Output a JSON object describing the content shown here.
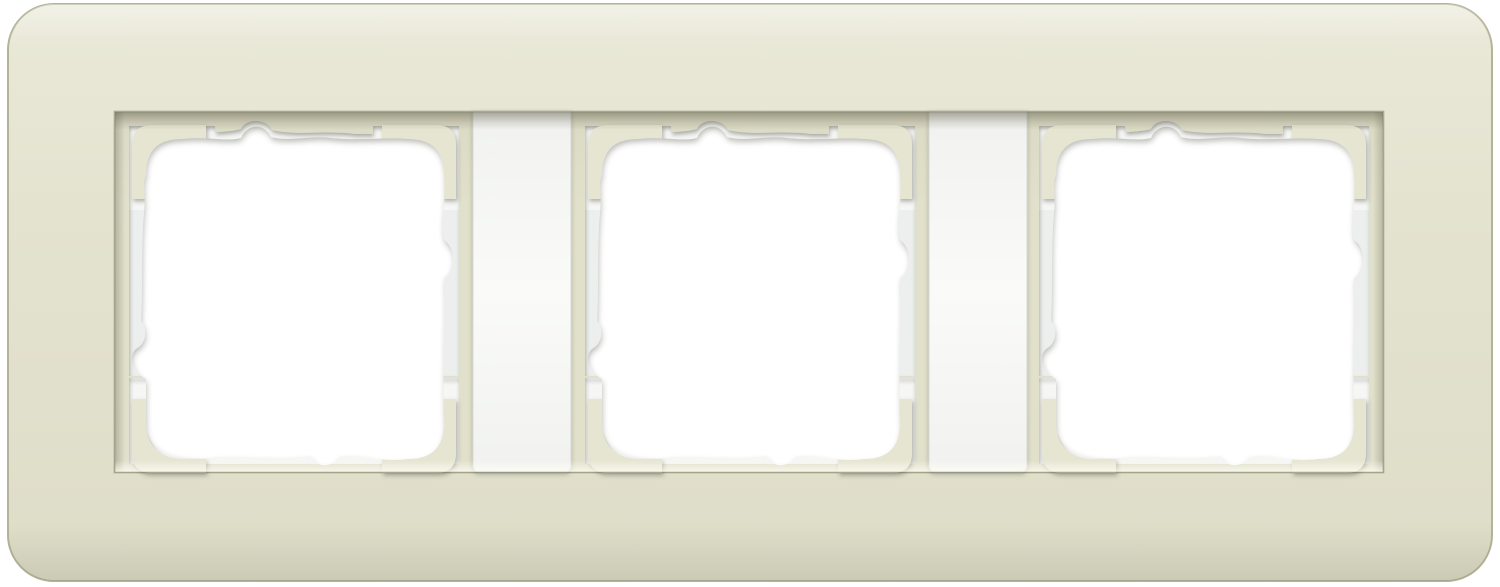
{
  "image": {
    "width": 1500,
    "height": 587,
    "description": "Product photo of a 3-gang electrical switch cover frame, sand colour with white inner carrier frame and two white divider bars",
    "openings_count": 3,
    "divider_count": 2
  },
  "colors": {
    "page_background": "#ffffff",
    "frame_sand_light": "#EAE9D8",
    "frame_sand": "#E4E3D0",
    "frame_sand_deep": "#DEDDC8",
    "frame_outline": "#B4B299",
    "recess_floor": "#E1E0CB",
    "recess_floor_dark": "#DBDAC4",
    "recess_edge_shadow": "#5A5844",
    "carrier_white": "#F6F7F5",
    "carrier_strip_grey": "#EDEFEE",
    "divider_top": "#F1F2F0",
    "divider_bottom": "#FAFBF9",
    "divider_edge": "#D8DAD6",
    "corner_band_sand": "#E6E5D2",
    "hole_white": "#FFFFFF",
    "recess_bottom_light": "#F4F3E4"
  },
  "parts": {
    "outer_frame": "sand soft-touch outer frame",
    "recess": "recessed mounting area",
    "opening_1": "module opening 1",
    "opening_2": "module opening 2",
    "opening_3": "module opening 3",
    "divider_1": "white divider bar 1",
    "divider_2": "white divider bar 2",
    "corner_brackets": "white carrier corner steps",
    "cutout": "wavy-cut module cut-out"
  }
}
